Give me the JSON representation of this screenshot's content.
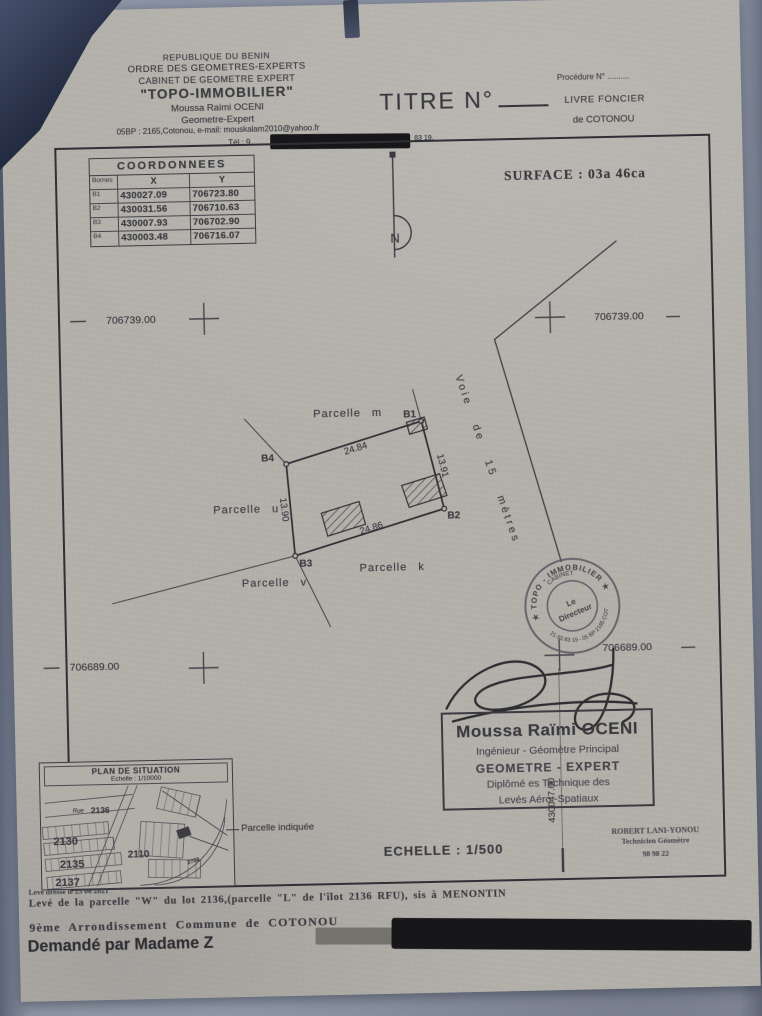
{
  "cabinet": {
    "line1": "REPUBLIQUE DU BENIN",
    "line2": "ORDRE DES GEOMETRES-EXPERTS",
    "line3": "CABINET DE GEOMETRE EXPERT",
    "line4": "\"TOPO-IMMOBILIER\"",
    "line5": "Moussa Raimi OCENI",
    "line6": "Geometre-Expert",
    "line7": "05BP : 2165,Cotonou, e-mail: mouskalam2010@yahoo.fr",
    "tel_prefix": "Tél : 9",
    "tel_suffix": "83 19."
  },
  "title_block": {
    "titre": "TITRE N°",
    "procedure": "Procédure N° ..........",
    "livre_foncier": "LIVRE FONCIER",
    "place": "de COTONOU"
  },
  "surface_label": "SURFACE : 03a 46ca",
  "coordinates_table": {
    "title": "COORDONNEES",
    "col_bornes": "Bornes",
    "col_x": "X",
    "col_y": "Y",
    "rows": [
      [
        "B1",
        "430027.09",
        "706723.80"
      ],
      [
        "B2",
        "430031.56",
        "706710.63"
      ],
      [
        "B3",
        "430007.93",
        "706702.90"
      ],
      [
        "B4",
        "430003.48",
        "706716.07"
      ]
    ]
  },
  "grid": {
    "y_top": "706739.00",
    "y_bottom": "706689.00",
    "x_right": "430047.00"
  },
  "plan": {
    "north": "N",
    "parcelles": {
      "m": "Parcelle m",
      "u": "Parcelle u",
      "k": "Parcelle k",
      "v": "Parcelle v"
    },
    "corners": {
      "b1": "B1",
      "b2": "B2",
      "b3": "B3",
      "b4": "B4"
    },
    "dims": {
      "top": "24.84",
      "right": "13.91",
      "bottom": "24.86",
      "left": "13.90"
    },
    "road": "Voie de 15 mètres"
  },
  "stamp": {
    "arc_top": "★ TOPO - IMMOBILIER ★",
    "arc_inner": "CABINET",
    "arc_bottom": "21-92 83 19 - 05 BP 2165 COT",
    "center_line1": "Le",
    "center_line2": "Directeur"
  },
  "surveyor": {
    "name": "Moussa Raïmi OCENI",
    "role1": "Ingénieur - Géomètre Principal",
    "role2": "GEOMETRE - EXPERT",
    "role3": "Diplômé es Technique des",
    "role4": "Levés Aéro -Spatiaux"
  },
  "scale_label": "ECHELLE : 1/500",
  "technician": {
    "name": "ROBERT LANI-YONOU",
    "role": "Technicien Géomètre",
    "phone": "98 98 22"
  },
  "situation": {
    "title": "PLAN DE SITUATION",
    "scale": "Echelle : 1/10000",
    "street": "Rue",
    "lots": {
      "l2136": "2136",
      "l2130": "2130",
      "l2135": "2135",
      "l2137": "2137",
      "l2110": "2110",
      "l2733": "2733"
    },
    "pointer": "Parcelle indiquée"
  },
  "footer": {
    "date_line": "Levé dressé le 23 06 2021",
    "line1": "Levé de la parcelle \"W\" du lot 2136,(parcelle \"L\" de l'îlot 2136 RFU), sis à MENONTIN",
    "line2": "9ème Arrondissement Commune de COTONOU",
    "line3": "Demandé par Madame Z"
  }
}
